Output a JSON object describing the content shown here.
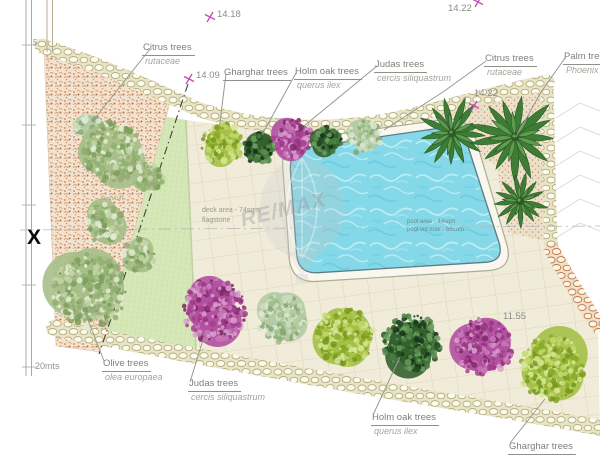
{
  "watermark": {
    "brand": "RE/MAX"
  },
  "ruler": {
    "top_label": "5",
    "bottom_label": "20mts"
  },
  "section_marker": {
    "text": "X"
  },
  "notes": {
    "deck_line1": "deck area - 74sqm",
    "deck_line2": "flagstone",
    "pool_line1": "pool area - 44sqm",
    "pool_line2": "pool vol max - 66cum",
    "lawn": "lawn/turf"
  },
  "elevation_markers": [
    {
      "value": "14.22",
      "x": 448,
      "y": 3,
      "cross": true,
      "cross_dx": 24,
      "cross_dy": -7
    },
    {
      "value": "14.18",
      "x": 217,
      "y": 9,
      "cross": true,
      "cross_dx": -13,
      "cross_dy": 2
    },
    {
      "value": "14.09",
      "x": 196,
      "y": 70,
      "cross": true,
      "cross_dx": -13,
      "cross_dy": 3
    },
    {
      "value": "14.22",
      "x": 474,
      "y": 88,
      "cross": true,
      "cross_dx": -6,
      "cross_dy": 12
    },
    {
      "value": "11.55",
      "x": 503,
      "y": 311,
      "cross": false,
      "cross_dx": 0,
      "cross_dy": 0
    }
  ],
  "plant_labels": [
    {
      "id": "citrus-top",
      "name": "Citrus trees",
      "species": "rutaceae",
      "x": 142,
      "y": 37
    },
    {
      "id": "gharghar-top",
      "name": "Gharghar trees",
      "species": "",
      "x": 223,
      "y": 62
    },
    {
      "id": "holm-oak-top",
      "name": "Holm oak trees",
      "species": "querus ilex",
      "x": 294,
      "y": 61
    },
    {
      "id": "judas-top",
      "name": "Judas trees",
      "species": "cercis siliquastrum",
      "x": 374,
      "y": 54
    },
    {
      "id": "citrus-top-right",
      "name": "Citrus trees",
      "species": "rutaceae",
      "x": 484,
      "y": 48
    },
    {
      "id": "palm",
      "name": "Palm trees",
      "species": "Phoenix",
      "x": 563,
      "y": 46
    },
    {
      "id": "olive",
      "name": "Olive trees",
      "species": "olea europaea",
      "x": 102,
      "y": 353
    },
    {
      "id": "judas-bottom",
      "name": "Judas trees",
      "species": "cercis siliquastrum",
      "x": 188,
      "y": 373
    },
    {
      "id": "holm-oak-bottom",
      "name": "Holm oak trees",
      "species": "querus ilex",
      "x": 371,
      "y": 407
    },
    {
      "id": "gharghar-bottom",
      "name": "Gharghar trees",
      "species": "",
      "x": 508,
      "y": 436
    }
  ],
  "trees": [
    {
      "type": "gharghar",
      "x": 222,
      "y": 144,
      "r": 22
    },
    {
      "type": "holm-oak",
      "x": 259,
      "y": 148,
      "r": 17
    },
    {
      "type": "judas",
      "x": 293,
      "y": 138,
      "r": 21
    },
    {
      "type": "holm-oak",
      "x": 328,
      "y": 140,
      "r": 16
    },
    {
      "type": "citrus",
      "x": 364,
      "y": 138,
      "r": 19
    },
    {
      "type": "palm",
      "x": 452,
      "y": 133,
      "r": 37
    },
    {
      "type": "palm",
      "x": 515,
      "y": 137,
      "r": 45
    },
    {
      "type": "palm",
      "x": 520,
      "y": 201,
      "r": 28
    },
    {
      "type": "citrus",
      "x": 88,
      "y": 126,
      "r": 14
    },
    {
      "type": "olive",
      "x": 112,
      "y": 152,
      "r": 32
    },
    {
      "type": "olive",
      "x": 149,
      "y": 177,
      "r": 16
    },
    {
      "type": "olive",
      "x": 103,
      "y": 223,
      "r": 21
    },
    {
      "type": "olive",
      "x": 139,
      "y": 255,
      "r": 17
    },
    {
      "type": "olive",
      "x": 90,
      "y": 291,
      "r": 40
    },
    {
      "type": "judas",
      "x": 214,
      "y": 310,
      "r": 34
    },
    {
      "type": "citrus",
      "x": 282,
      "y": 319,
      "r": 26
    },
    {
      "type": "gharghar",
      "x": 345,
      "y": 336,
      "r": 31
    },
    {
      "type": "holm-oak",
      "x": 412,
      "y": 343,
      "r": 31
    },
    {
      "type": "judas",
      "x": 483,
      "y": 347,
      "r": 31
    },
    {
      "type": "gharghar",
      "x": 552,
      "y": 368,
      "r": 35
    }
  ],
  "palette": {
    "marker_magenta": "#c24fb0",
    "leader_gray": "#98988f",
    "water": "#84d8e7",
    "olive": {
      "base": "#a7bf8a",
      "spots": [
        "#8db26d",
        "#c3d5a6",
        "#7b9e5d",
        "#e2ecd2",
        "#96ac74"
      ]
    },
    "citrus": {
      "base": "#b4cba4",
      "spots": [
        "#9cbd8a",
        "#cbdcbd",
        "#86a873",
        "#dde8d4"
      ]
    },
    "gharghar": {
      "base": "#a4c046",
      "spots": [
        "#89a928",
        "#c2d96d",
        "#76961c",
        "#d6e795"
      ]
    },
    "holm-oak": {
      "base": "#33602e",
      "spots": [
        "#224c20",
        "#4a7f41",
        "#5d9150",
        "#15351a",
        "#6fa060"
      ]
    },
    "judas": {
      "base": "#b151a1",
      "spots": [
        "#97357f",
        "#c878b8",
        "#7c2868",
        "#d9a1cd",
        "#a53f90"
      ]
    },
    "palm": {
      "base": "#3e7d35",
      "light": "#5f9b50",
      "dark": "#2a5a25"
    }
  }
}
